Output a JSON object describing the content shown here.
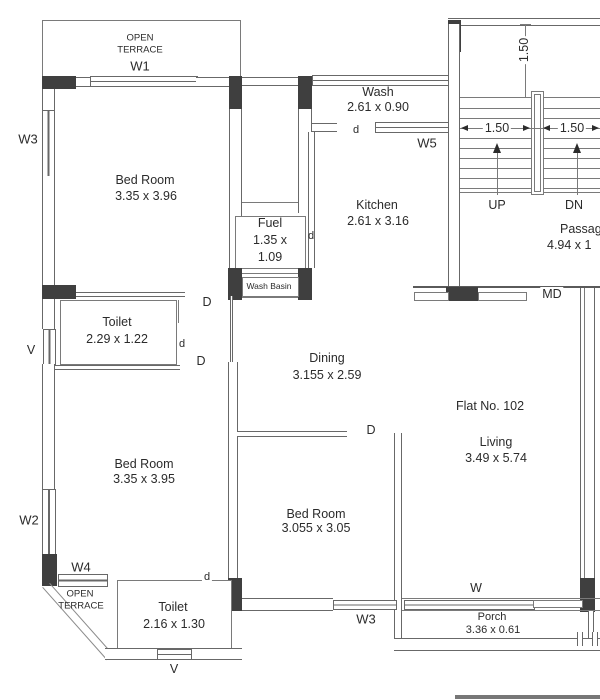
{
  "drawing": {
    "flat_label": "Flat No. 102",
    "colors": {
      "line": "#7a7a7a",
      "column_fill": "#3f3f3f",
      "text": "#2b2b2b",
      "background": "#ffffff"
    },
    "rooms": {
      "terrace_top": {
        "name_line1": "OPEN",
        "name_line2": "TERRACE"
      },
      "bedroom_top": {
        "name": "Bed Room",
        "size": "3.35 x 3.96"
      },
      "wash": {
        "name": "Wash",
        "size": "2.61 x 0.90"
      },
      "kitchen": {
        "name": "Kitchen",
        "size": "2.61 x 3.16"
      },
      "fuel": {
        "name": "Fuel",
        "size_line1": "1.35 x",
        "size_line2": "1.09"
      },
      "wash_basin": {
        "name": "Wash Basin"
      },
      "toilet_mid": {
        "name": "Toilet",
        "size": "2.29 x 1.22"
      },
      "dining": {
        "name": "Dining",
        "size": "3.155 x 2.59"
      },
      "passage": {
        "name": "Passage",
        "size": "4.94 x 1"
      },
      "living": {
        "name": "Living",
        "size": "3.49 x 5.74"
      },
      "bedroom_left": {
        "name": "Bed Room",
        "size": "3.35 x 3.95"
      },
      "bedroom_bottom": {
        "name": "Bed Room",
        "size": "3.055 x 3.05"
      },
      "terrace_bottom": {
        "name_line1": "OPEN",
        "name_line2": "TERRACE"
      },
      "toilet_bottom": {
        "name": "Toilet",
        "size": "2.16 x 1.30"
      },
      "porch": {
        "name": "Porch",
        "size": "3.36 x 0.61"
      }
    },
    "stairs": {
      "up": "UP",
      "down": "DN",
      "dim_vertical": "1.50",
      "dim_left": "1.50",
      "dim_right": "1.50"
    },
    "openings": {
      "w1": "W1",
      "w3_upper": "W3",
      "w5": "W5",
      "w2": "W2",
      "w4": "W4",
      "w3_lower": "W3",
      "w_porch": "W",
      "v_mid": "V",
      "v_bottom": "V",
      "md": "MD",
      "door_wash": "d",
      "door_fuel": "d",
      "door_toilet_mid": "d",
      "door_toilet_bottom": "d",
      "door_bedroom_top": "D",
      "door_bedroom_left": "D",
      "door_bedroom_bottom": "D"
    }
  }
}
